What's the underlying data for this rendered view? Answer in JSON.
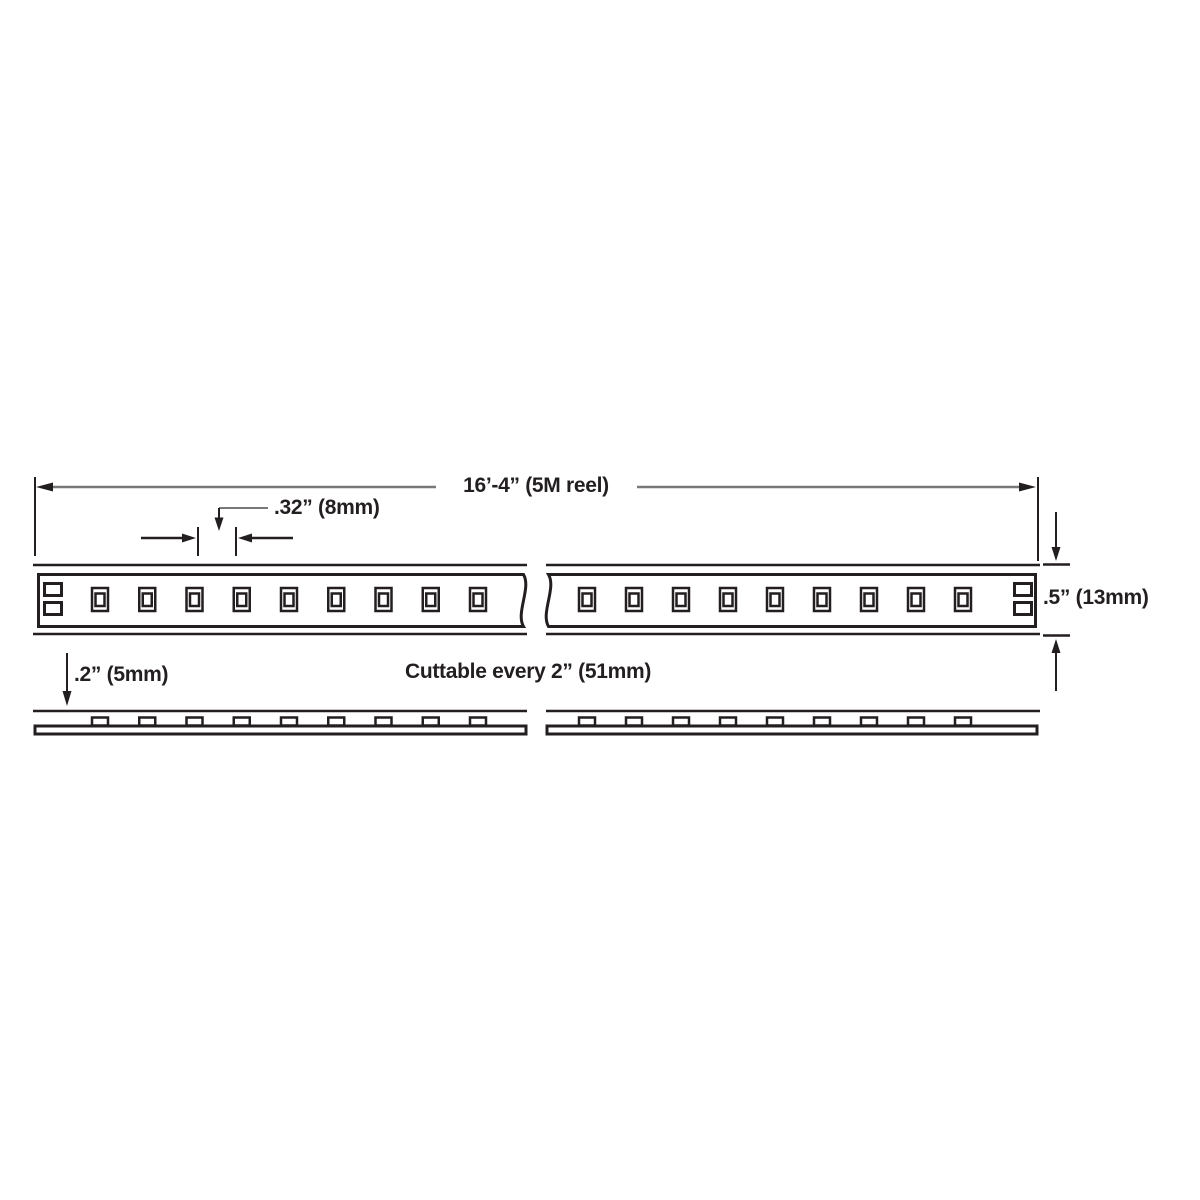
{
  "diagram": {
    "type": "led-strip-dimension-drawing",
    "labels": {
      "reel_length": "16’-4” (5M reel)",
      "led_pitch": ".32” (8mm)",
      "strip_width": ".5” (13mm)",
      "strip_thickness": ".2” (5mm)",
      "cut_note": "Cuttable every 2” (51mm)"
    },
    "strip": {
      "segments": 2,
      "leds_per_segment": 9,
      "pads_per_end": 2
    },
    "colors": {
      "line": "#231f20",
      "dimension_line": "#77787a",
      "background": "#ffffff"
    }
  }
}
